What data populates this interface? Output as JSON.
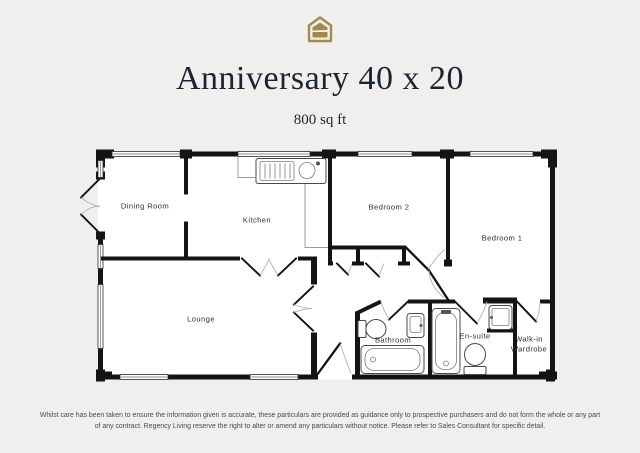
{
  "header": {
    "logo": "house-logo",
    "title": "Anniversary 40 x 20",
    "subtitle": "800 sq ft"
  },
  "floorplan": {
    "rooms": {
      "dining_room": "Dining Room",
      "kitchen": "Kitchen",
      "bedroom_2": "Bedroom 2",
      "bedroom_1": "Bedroom 1",
      "lounge": "Lounge",
      "bathroom": "Bathroom",
      "en_suite": "En-suite",
      "wardrobe_line_1": "Walk-in",
      "wardrobe_line_2": "Wardrobe"
    },
    "fixtures": [
      "kitchen-sink",
      "bath",
      "toilet",
      "basin",
      "bath-vertical",
      "counter"
    ]
  },
  "footer": {
    "disclaimer_line_1": "Whilst care has been taken to ensure the information given is accurate, these particulars are provided as guidance only to prospective purchasers and do not form the whole or any part",
    "disclaimer_line_2": "of any contract. Regency Living reserve the right to alter or amend any particulars without notice. Please refer to Sales Consultant for specific detail."
  },
  "colors": {
    "background": "#f0efed",
    "wall": "#141414",
    "room_fill": "#ffffff",
    "accent_gold": "#a1894f",
    "title_text": "#1b2433"
  }
}
